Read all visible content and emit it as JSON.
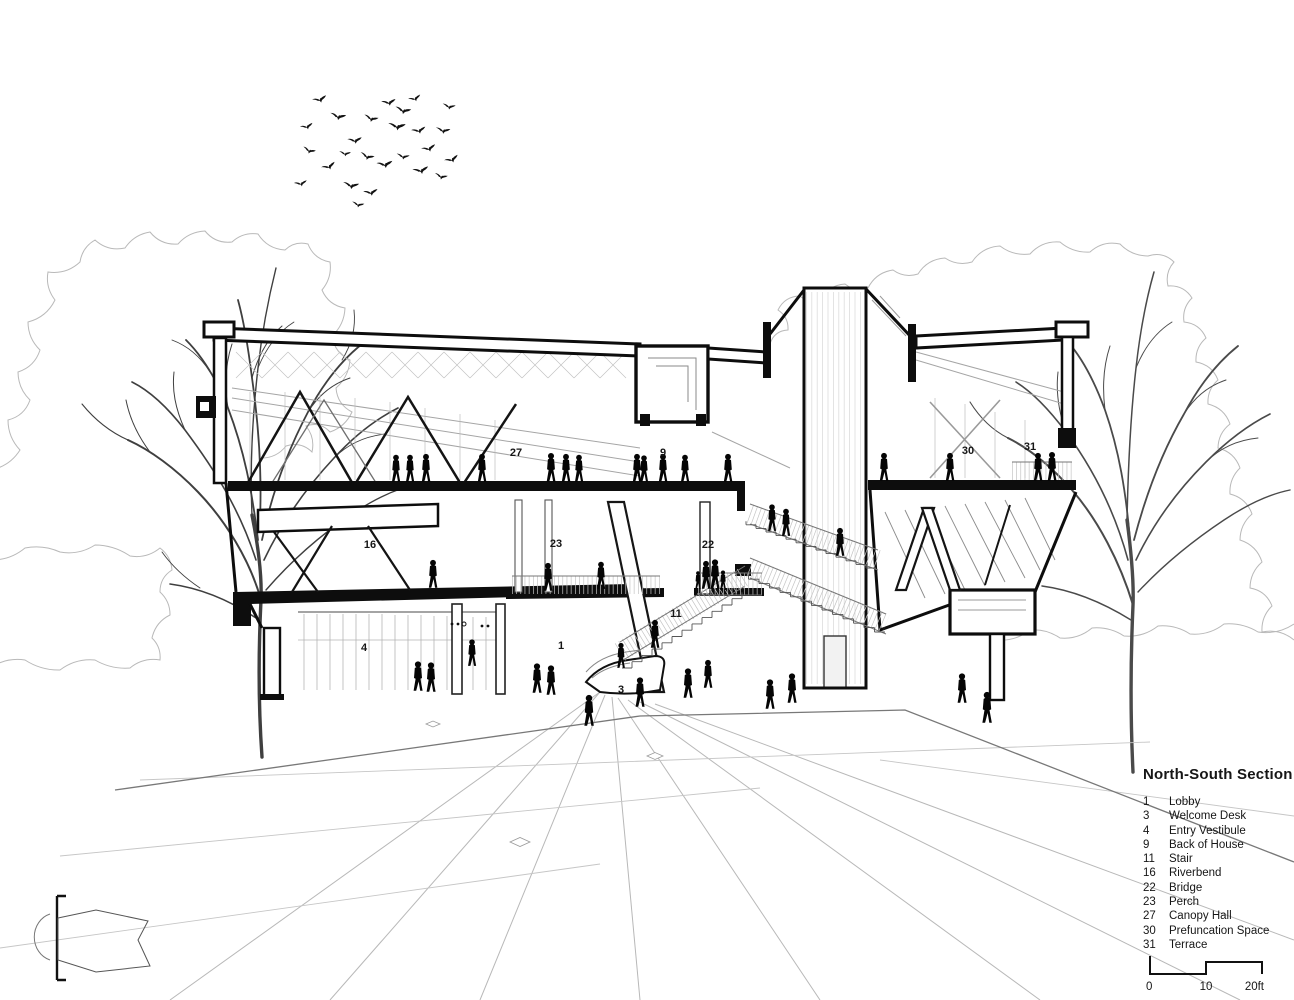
{
  "legend": {
    "title": "North-South Section",
    "items": [
      {
        "num": "1",
        "label": "Lobby"
      },
      {
        "num": "3",
        "label": "Welcome Desk"
      },
      {
        "num": "4",
        "label": "Entry Vestibule"
      },
      {
        "num": "9",
        "label": "Back of House"
      },
      {
        "num": "11",
        "label": "Stair"
      },
      {
        "num": "16",
        "label": "Riverbend"
      },
      {
        "num": "22",
        "label": "Bridge"
      },
      {
        "num": "23",
        "label": "Perch"
      },
      {
        "num": "27",
        "label": "Canopy Hall"
      },
      {
        "num": "30",
        "label": "Prefuncation Space"
      },
      {
        "num": "31",
        "label": "Terrace"
      }
    ]
  },
  "scale_bar": {
    "start": "0",
    "mid": "10",
    "end": "20ft"
  },
  "colors": {
    "ink": "#0d0d0d",
    "light_line": "#9e9e9e",
    "canopy": "#b9b9b9",
    "paper": "#ffffff"
  },
  "annotations": [
    {
      "num": "27",
      "x": 516,
      "y": 456
    },
    {
      "num": "9",
      "x": 663,
      "y": 456
    },
    {
      "num": "30",
      "x": 968,
      "y": 454
    },
    {
      "num": "31",
      "x": 1030,
      "y": 450
    },
    {
      "num": "16",
      "x": 370,
      "y": 548
    },
    {
      "num": "23",
      "x": 556,
      "y": 547
    },
    {
      "num": "22",
      "x": 708,
      "y": 548
    },
    {
      "num": "11",
      "x": 676,
      "y": 617
    },
    {
      "num": "4",
      "x": 364,
      "y": 651
    },
    {
      "num": "1",
      "x": 561,
      "y": 649
    },
    {
      "num": "3",
      "x": 621,
      "y": 693
    }
  ],
  "scene": {
    "people": [
      [
        396,
        482,
        0.92
      ],
      [
        410,
        482,
        0.92
      ],
      [
        426,
        482,
        0.95
      ],
      [
        482,
        482,
        0.95
      ],
      [
        551,
        482,
        0.98
      ],
      [
        566,
        482,
        0.95
      ],
      [
        579,
        482,
        0.92
      ],
      [
        637,
        482,
        0.95
      ],
      [
        644,
        482,
        0.9
      ],
      [
        663,
        482,
        0.95
      ],
      [
        685,
        482,
        0.92
      ],
      [
        728,
        482,
        0.95
      ],
      [
        884,
        481,
        0.95
      ],
      [
        950,
        481,
        0.95
      ],
      [
        1038,
        481,
        0.95
      ],
      [
        1052,
        481,
        0.98
      ],
      [
        772,
        531,
        0.9
      ],
      [
        786,
        536,
        0.92
      ],
      [
        840,
        556,
        0.95
      ],
      [
        698,
        589,
        0.6
      ],
      [
        706,
        589,
        0.95
      ],
      [
        715,
        589,
        1.0
      ],
      [
        723,
        590,
        0.66
      ],
      [
        548,
        591,
        0.95
      ],
      [
        601,
        589,
        0.92
      ],
      [
        433,
        588,
        0.95
      ],
      [
        655,
        648,
        0.95
      ],
      [
        621,
        668,
        0.85
      ],
      [
        418,
        691,
        1
      ],
      [
        431,
        692,
        1
      ],
      [
        472,
        666,
        0.9
      ],
      [
        537,
        693,
        1
      ],
      [
        551,
        695,
        1
      ],
      [
        589,
        726,
        1.05
      ],
      [
        640,
        707,
        1
      ],
      [
        688,
        698,
        1
      ],
      [
        708,
        688,
        0.95
      ],
      [
        770,
        709,
        1
      ],
      [
        792,
        703,
        1
      ],
      [
        962,
        703,
        1
      ],
      [
        987,
        723,
        1.05
      ]
    ],
    "birds": [
      [
        320,
        100,
        -15,
        1
      ],
      [
        338,
        117,
        10,
        1.1
      ],
      [
        355,
        141,
        -5,
        1
      ],
      [
        309,
        151,
        20,
        0.9
      ],
      [
        329,
        167,
        -20,
        1
      ],
      [
        351,
        186,
        8,
        1.1
      ],
      [
        301,
        184,
        -10,
        0.9
      ],
      [
        371,
        119,
        15,
        1
      ],
      [
        389,
        103,
        -8,
        1
      ],
      [
        403,
        111,
        12,
        1.1
      ],
      [
        415,
        99,
        -18,
        0.9
      ],
      [
        397,
        127,
        5,
        1.2
      ],
      [
        419,
        131,
        -12,
        1
      ],
      [
        367,
        157,
        18,
        1
      ],
      [
        385,
        165,
        -6,
        1.1
      ],
      [
        403,
        157,
        10,
        0.9
      ],
      [
        429,
        149,
        -15,
        1
      ],
      [
        443,
        131,
        8,
        1
      ],
      [
        421,
        171,
        -10,
        1.1
      ],
      [
        441,
        177,
        14,
        0.9
      ],
      [
        371,
        193,
        -8,
        1
      ],
      [
        449,
        107,
        10,
        0.9
      ],
      [
        307,
        127,
        -14,
        0.9
      ],
      [
        345,
        154,
        6,
        0.8
      ],
      [
        452,
        160,
        -20,
        1
      ],
      [
        358,
        205,
        12,
        0.85
      ]
    ]
  }
}
